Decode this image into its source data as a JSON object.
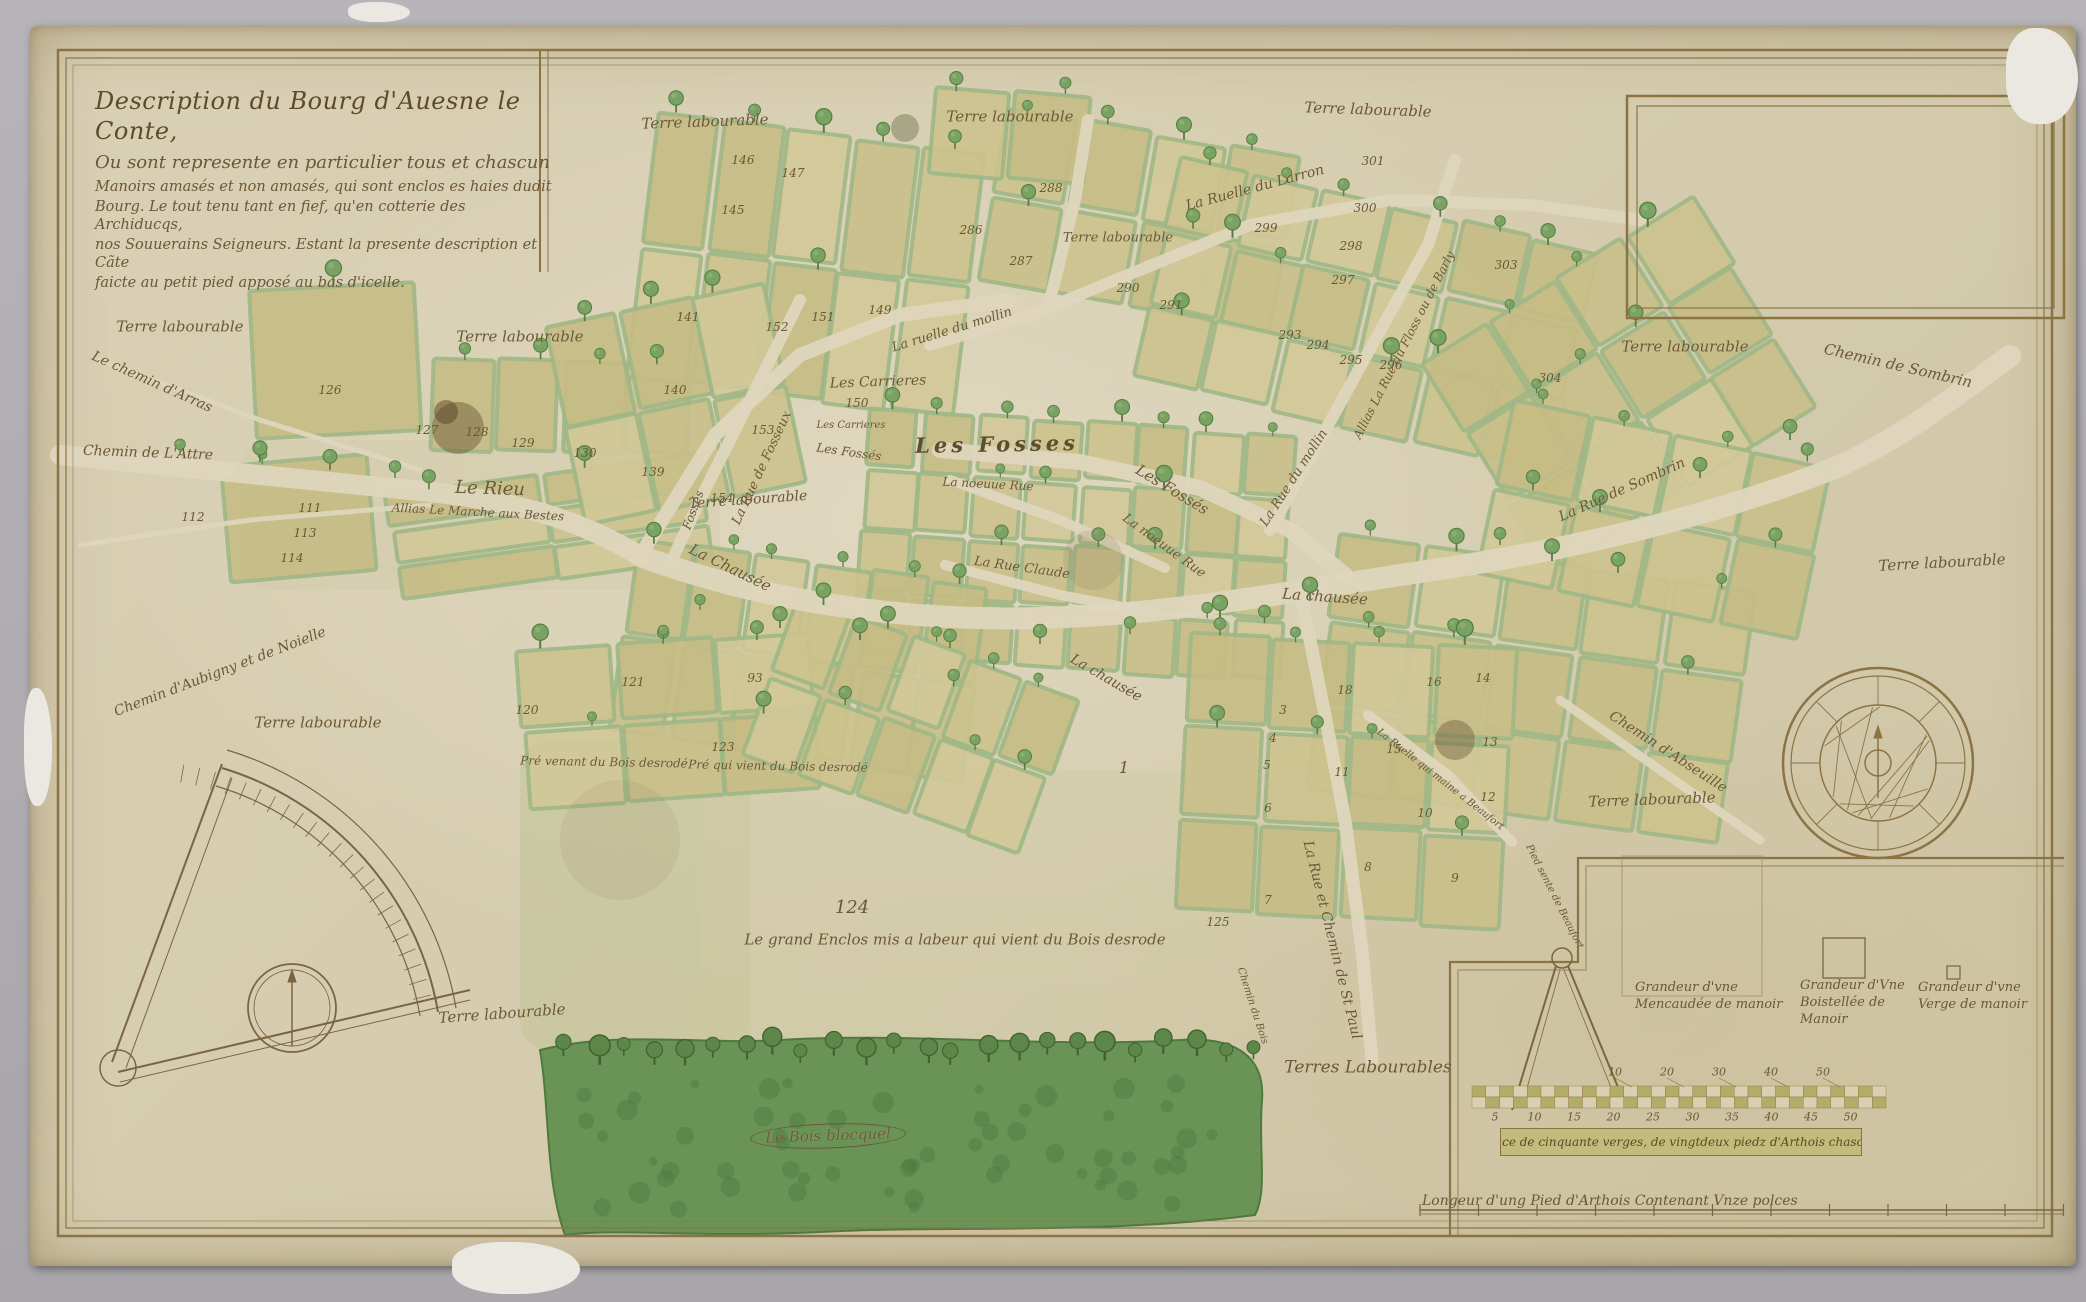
{
  "title": {
    "lines": [
      "Description du Bourg d'Auesne le Conte,",
      "Ou sont represente en particulier tous et chascun",
      "Manoirs amasés et non amasés, qui sont enclos es haies dudit",
      "Bourg. Le tout tenu tant en fief, qu'en cotterie des Archiducqs,",
      "nos Souuerains Seigneurs. Estant la presente description et Cãte",
      "faicte au petit pied apposé au bas d'icelle."
    ]
  },
  "labels": {
    "areas": [
      {
        "t": "Terre labourable",
        "x": 705,
        "y": 122,
        "r": -2,
        "s": 15
      },
      {
        "t": "Terre labourable",
        "x": 1010,
        "y": 117,
        "r": 0,
        "s": 15
      },
      {
        "t": "Terre labourable",
        "x": 1368,
        "y": 110,
        "r": 2,
        "s": 15
      },
      {
        "t": "Terre labourable",
        "x": 1118,
        "y": 238,
        "r": 0,
        "s": 13
      },
      {
        "t": "Terre labourable",
        "x": 180,
        "y": 327,
        "r": 0,
        "s": 15
      },
      {
        "t": "Terre labourable",
        "x": 520,
        "y": 337,
        "r": 0,
        "s": 15
      },
      {
        "t": "Terre labourable",
        "x": 748,
        "y": 500,
        "r": -4,
        "s": 14
      },
      {
        "t": "Terre labourable",
        "x": 1685,
        "y": 347,
        "r": 0,
        "s": 15
      },
      {
        "t": "Terre labourable",
        "x": 1942,
        "y": 563,
        "r": -3,
        "s": 15
      },
      {
        "t": "Terre labourable",
        "x": 1652,
        "y": 800,
        "r": -2,
        "s": 15
      },
      {
        "t": "Terre labourable",
        "x": 318,
        "y": 723,
        "r": 0,
        "s": 15
      },
      {
        "t": "Terre labourable",
        "x": 502,
        "y": 1014,
        "r": -4,
        "s": 15
      },
      {
        "t": "Terres Labourables",
        "x": 1368,
        "y": 1068,
        "r": 0,
        "s": 17
      }
    ],
    "roads": [
      {
        "t": "Le chemin d'Arras",
        "x": 152,
        "y": 382,
        "r": 24,
        "s": 14
      },
      {
        "t": "Chemin de L'Attre",
        "x": 148,
        "y": 453,
        "r": 2,
        "s": 14
      },
      {
        "t": "Chemin d'Aubigny et de Noielle",
        "x": 220,
        "y": 672,
        "r": -21,
        "s": 14
      },
      {
        "t": "Le Rieu",
        "x": 490,
        "y": 489,
        "r": 2,
        "s": 18
      },
      {
        "t": "Allias Le Marche aux Bestes",
        "x": 478,
        "y": 512,
        "r": 3,
        "s": 12
      },
      {
        "t": "La Chausée",
        "x": 730,
        "y": 568,
        "r": 26,
        "s": 15
      },
      {
        "t": "La chausée",
        "x": 1325,
        "y": 597,
        "r": 4,
        "s": 15
      },
      {
        "t": "La chausée",
        "x": 1106,
        "y": 678,
        "r": 30,
        "s": 14
      },
      {
        "t": "La Rue de Fosseux",
        "x": 762,
        "y": 468,
        "r": -65,
        "s": 13
      },
      {
        "t": "Fossés",
        "x": 693,
        "y": 510,
        "r": -70,
        "s": 12
      },
      {
        "t": "Les Fosses",
        "x": 997,
        "y": 444,
        "r": -1,
        "s": 21,
        "c": "big"
      },
      {
        "t": "Les Fossés",
        "x": 1172,
        "y": 490,
        "r": 31,
        "s": 15
      },
      {
        "t": "Les Fossés",
        "x": 849,
        "y": 452,
        "r": 8,
        "s": 12
      },
      {
        "t": "Les Carrieres",
        "x": 878,
        "y": 382,
        "r": -2,
        "s": 14
      },
      {
        "t": "Les Carrieres",
        "x": 851,
        "y": 426,
        "r": 0,
        "s": 10
      },
      {
        "t": "La noeuue Rue",
        "x": 988,
        "y": 484,
        "r": 3,
        "s": 12
      },
      {
        "t": "La noeuue Rue",
        "x": 1164,
        "y": 546,
        "r": 36,
        "s": 13
      },
      {
        "t": "La Rue Claude",
        "x": 1022,
        "y": 568,
        "r": 8,
        "s": 13
      },
      {
        "t": "La ruelle du mollin",
        "x": 952,
        "y": 330,
        "r": -17,
        "s": 13
      },
      {
        "t": "La Rue du mollin",
        "x": 1294,
        "y": 478,
        "r": -57,
        "s": 13
      },
      {
        "t": "Allias La Rue du Floss ou de Barly",
        "x": 1404,
        "y": 345,
        "r": -63,
        "s": 12
      },
      {
        "t": "La Ruelle du Larron",
        "x": 1255,
        "y": 188,
        "r": -15,
        "s": 14
      },
      {
        "t": "La Rue de Sombrin",
        "x": 1622,
        "y": 490,
        "r": -24,
        "s": 14
      },
      {
        "t": "Chemin de Sombrin",
        "x": 1898,
        "y": 366,
        "r": 13,
        "s": 15
      },
      {
        "t": "Chemin d'Abseuille",
        "x": 1668,
        "y": 752,
        "r": 33,
        "s": 14
      },
      {
        "t": "La Rue et Chemin de St Paul",
        "x": 1332,
        "y": 940,
        "r": 76,
        "s": 14
      },
      {
        "t": "Chemin du Bois",
        "x": 1252,
        "y": 1006,
        "r": 72,
        "s": 10
      },
      {
        "t": "La Ruelle qui maine a Beaufort",
        "x": 1440,
        "y": 780,
        "r": 38,
        "s": 10
      },
      {
        "t": "Pied sente de Beaufort",
        "x": 1554,
        "y": 897,
        "r": 63,
        "s": 10
      }
    ],
    "places": [
      {
        "t": "Pré venant du Bois desrodé",
        "x": 604,
        "y": 762,
        "r": 1,
        "s": 12
      },
      {
        "t": "Pré qui vient du Bois desrodé",
        "x": 778,
        "y": 766,
        "r": 1,
        "s": 12
      },
      {
        "t": "Le grand Enclos mis a labeur qui vient du Bois desrode",
        "x": 955,
        "y": 940,
        "r": 0,
        "s": 15
      },
      {
        "t": "Le Bois blocquel",
        "x": 828,
        "y": 1136,
        "r": -2,
        "s": 15,
        "c": "oval"
      }
    ]
  },
  "parcel_numbers": [
    {
      "n": "146",
      "x": 743,
      "y": 160
    },
    {
      "n": "147",
      "x": 793,
      "y": 173
    },
    {
      "n": "145",
      "x": 733,
      "y": 210
    },
    {
      "n": "288",
      "x": 1051,
      "y": 188
    },
    {
      "n": "286",
      "x": 971,
      "y": 230
    },
    {
      "n": "287",
      "x": 1021,
      "y": 261
    },
    {
      "n": "290",
      "x": 1128,
      "y": 288
    },
    {
      "n": "291",
      "x": 1171,
      "y": 305
    },
    {
      "n": "299",
      "x": 1266,
      "y": 228
    },
    {
      "n": "300",
      "x": 1365,
      "y": 208
    },
    {
      "n": "301",
      "x": 1373,
      "y": 161
    },
    {
      "n": "298",
      "x": 1351,
      "y": 246
    },
    {
      "n": "297",
      "x": 1343,
      "y": 280
    },
    {
      "n": "293",
      "x": 1290,
      "y": 335
    },
    {
      "n": "294",
      "x": 1318,
      "y": 345
    },
    {
      "n": "295",
      "x": 1351,
      "y": 360
    },
    {
      "n": "296",
      "x": 1391,
      "y": 365
    },
    {
      "n": "303",
      "x": 1506,
      "y": 265
    },
    {
      "n": "304",
      "x": 1550,
      "y": 378
    },
    {
      "n": "126",
      "x": 330,
      "y": 390
    },
    {
      "n": "127",
      "x": 427,
      "y": 430
    },
    {
      "n": "128",
      "x": 477,
      "y": 432
    },
    {
      "n": "129",
      "x": 523,
      "y": 443
    },
    {
      "n": "130",
      "x": 585,
      "y": 453
    },
    {
      "n": "139",
      "x": 653,
      "y": 472
    },
    {
      "n": "140",
      "x": 675,
      "y": 390
    },
    {
      "n": "141",
      "x": 688,
      "y": 317
    },
    {
      "n": "152",
      "x": 777,
      "y": 327
    },
    {
      "n": "151",
      "x": 823,
      "y": 317
    },
    {
      "n": "149",
      "x": 880,
      "y": 310
    },
    {
      "n": "150",
      "x": 857,
      "y": 403
    },
    {
      "n": "153",
      "x": 763,
      "y": 430
    },
    {
      "n": "154",
      "x": 722,
      "y": 498
    },
    {
      "n": "111",
      "x": 310,
      "y": 508
    },
    {
      "n": "112",
      "x": 193,
      "y": 517
    },
    {
      "n": "113",
      "x": 305,
      "y": 533
    },
    {
      "n": "114",
      "x": 292,
      "y": 558
    },
    {
      "n": "120",
      "x": 527,
      "y": 710
    },
    {
      "n": "121",
      "x": 633,
      "y": 682
    },
    {
      "n": "123",
      "x": 723,
      "y": 747
    },
    {
      "n": "93",
      "x": 755,
      "y": 678
    },
    {
      "n": "125",
      "x": 1218,
      "y": 922
    },
    {
      "n": "1",
      "x": 1124,
      "y": 768,
      "s": 16
    },
    {
      "n": "7",
      "x": 1268,
      "y": 900
    },
    {
      "n": "8",
      "x": 1368,
      "y": 867
    },
    {
      "n": "9",
      "x": 1455,
      "y": 878
    },
    {
      "n": "10",
      "x": 1425,
      "y": 813
    },
    {
      "n": "11",
      "x": 1342,
      "y": 772
    },
    {
      "n": "12",
      "x": 1488,
      "y": 797
    },
    {
      "n": "13",
      "x": 1490,
      "y": 742
    },
    {
      "n": "3",
      "x": 1283,
      "y": 710
    },
    {
      "n": "4",
      "x": 1273,
      "y": 738
    },
    {
      "n": "5",
      "x": 1267,
      "y": 765
    },
    {
      "n": "6",
      "x": 1268,
      "y": 808
    },
    {
      "n": "14",
      "x": 1483,
      "y": 678
    },
    {
      "n": "16",
      "x": 1434,
      "y": 682
    },
    {
      "n": "18",
      "x": 1345,
      "y": 690
    },
    {
      "n": "15",
      "x": 1394,
      "y": 749
    },
    {
      "n": "124",
      "x": 852,
      "y": 908,
      "s": 18
    }
  ],
  "legend": {
    "grandeur_mencaudee": "Grandeur d'vne Mencaudée de manoir",
    "grandeur_boistellee": "Grandeur d'Vne Boistellée de Manoir",
    "grandeur_verge": "Grandeur d'vne Verge de manoir",
    "espace_caption": "Espace de cinquante verges, de vingtdeux piedz d'Arthois chascune.",
    "pied_caption": "Longeur d'ung Pied d'Arthois Contenant Vnze polces",
    "scale_top_ticks": [
      "10",
      "20",
      "30",
      "40",
      "50"
    ],
    "scale_bottom_ticks": [
      "5",
      "10",
      "15",
      "20",
      "25",
      "30",
      "35",
      "40",
      "45",
      "50"
    ]
  },
  "colors": {
    "parchment": "#d6cdb0",
    "ink": "#6b5836",
    "frame": "#8c7344",
    "parcel_olive": "#ccc28d",
    "hedge_green": "#9fb786",
    "wood_green": "#6a9455",
    "street": "#ded6bd",
    "surround_gray": "#aeacb0"
  }
}
